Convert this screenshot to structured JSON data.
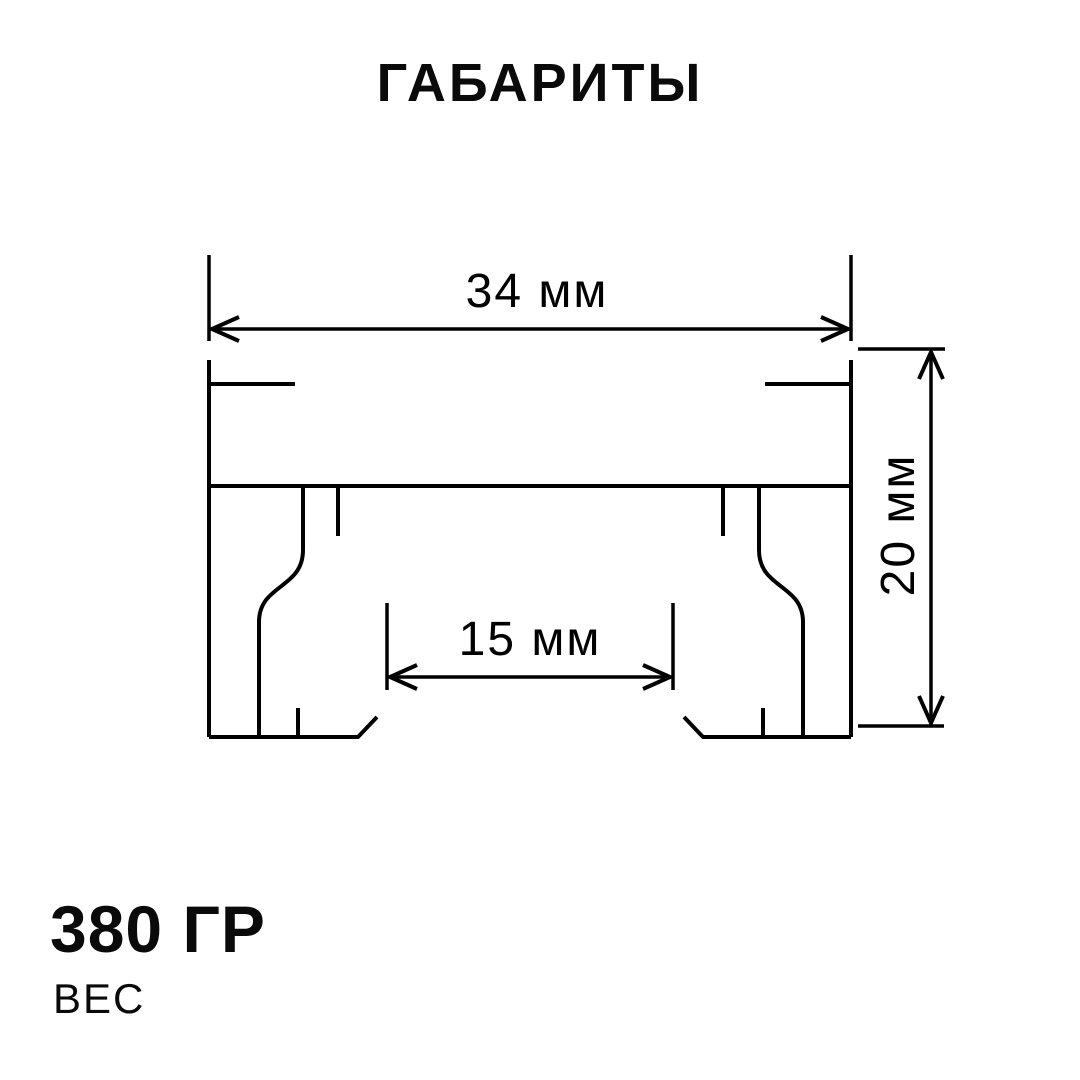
{
  "title": "ГАБАРИТЫ",
  "diagram": {
    "name": "profile-cross-section",
    "dimensions": {
      "width": {
        "label": "34 мм",
        "value": 34,
        "unit": "мм"
      },
      "inner_width": {
        "label": "15 мм",
        "value": 15,
        "unit": "мм"
      },
      "height": {
        "label": "20 мм",
        "value": 20,
        "unit": "мм"
      }
    }
  },
  "weight": {
    "value": "380 ГР",
    "label": "ВЕС"
  },
  "colors": {
    "background": "#ffffff",
    "line": "#000000",
    "text": "#0a0a0a"
  }
}
